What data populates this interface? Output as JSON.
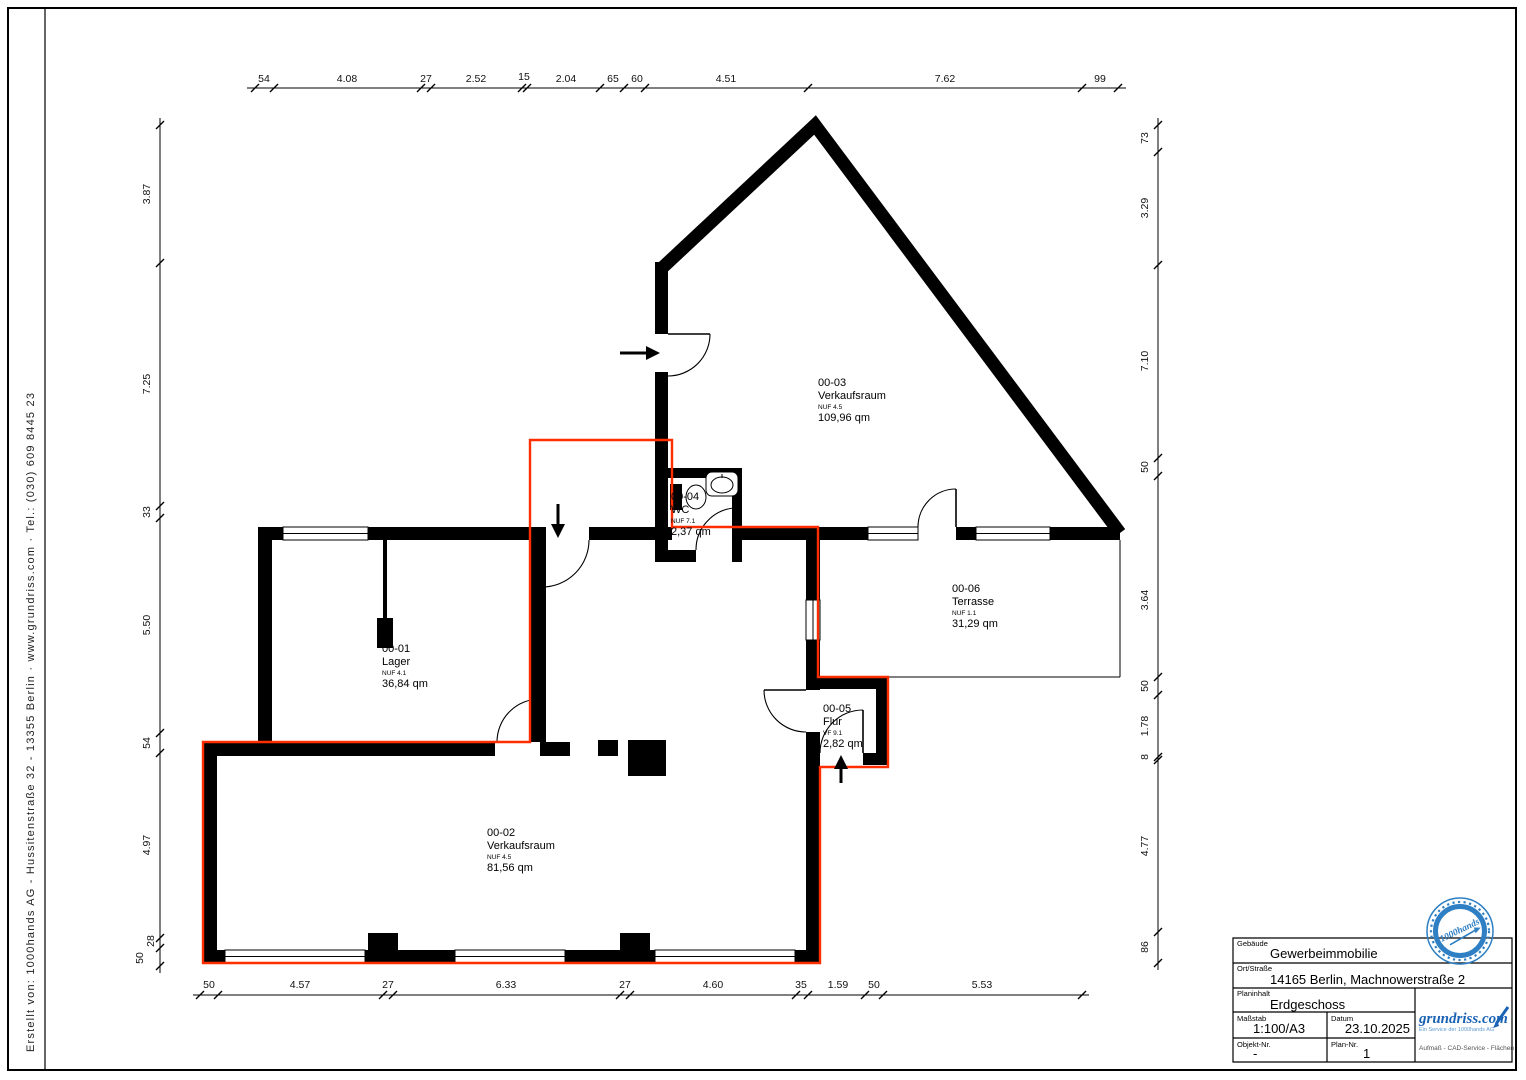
{
  "document": {
    "type": "Grundriss / floor plan sheet",
    "creator_line": "Erstellt von:    1000hands AG  -  Hussitenstraße 32 - 13355 Berlin    ·    www.grundriss.com    ·    Tel.: (030) 609 8445 23"
  },
  "rooms": [
    {
      "id": "00-01",
      "name": "Lager",
      "classification": "NUF 4.1",
      "area": "36,84 qm"
    },
    {
      "id": "00-02",
      "name": "Verkaufsraum",
      "classification": "NUF 4.5",
      "area": "81,56 qm"
    },
    {
      "id": "00-03",
      "name": "Verkaufsraum",
      "classification": "NUF 4.5",
      "area": "109,96 qm"
    },
    {
      "id": "00-04",
      "name": "WC",
      "classification": "NUF 7.1",
      "area": "2,37 qm"
    },
    {
      "id": "00-05",
      "name": "Flur",
      "classification": "VF 9.1",
      "area": "2,82 qm"
    },
    {
      "id": "00-06",
      "name": "Terrasse",
      "classification": "NUF 1.1",
      "area": "31,29 qm"
    }
  ],
  "dimensions": {
    "top": [
      "54",
      "4.08",
      "27",
      "2.52",
      "15",
      "2.04",
      "65",
      "60",
      "4.51",
      "7.62",
      "99"
    ],
    "left": [
      "3.87",
      "7.25",
      "33",
      "5.50",
      "54",
      "4.97",
      "28",
      "50"
    ],
    "right": [
      "73",
      "3.29",
      "7.10",
      "50",
      "3.64",
      "50",
      "1.78",
      "8",
      "4.77",
      "86"
    ],
    "bottom": [
      "50",
      "4.57",
      "27",
      "6.33",
      "27",
      "4.60",
      "35",
      "1.59",
      "50",
      "5.53"
    ]
  },
  "title_block": {
    "fields": [
      {
        "label": "Gebäude",
        "value": "Gewerbeimmobilie"
      },
      {
        "label": "Ort/Straße",
        "value": "14165 Berlin, Machnowerstraße 2"
      },
      {
        "label": "Planinhalt",
        "value": "Erdgeschoss"
      },
      {
        "label": "Maßstab",
        "value": "1:100/A3"
      },
      {
        "label": "Datum",
        "value": "23.10.2025"
      },
      {
        "label": "Objekt-Nr.",
        "value": "-"
      },
      {
        "label": "Plan-Nr.",
        "value": "1"
      }
    ],
    "logo": {
      "brand": "grundriss.com",
      "tagline": "Ein Service der 1000hands AG",
      "services": "Aufmaß - CAD-Service - Flächen"
    }
  },
  "stamp": {
    "text": "1000hands"
  },
  "colors": {
    "wall": "#000000",
    "unit_highlight": "#ff2e00",
    "brand_blue": "#1a62b4",
    "stamp_blue": "#2e7fc3"
  }
}
